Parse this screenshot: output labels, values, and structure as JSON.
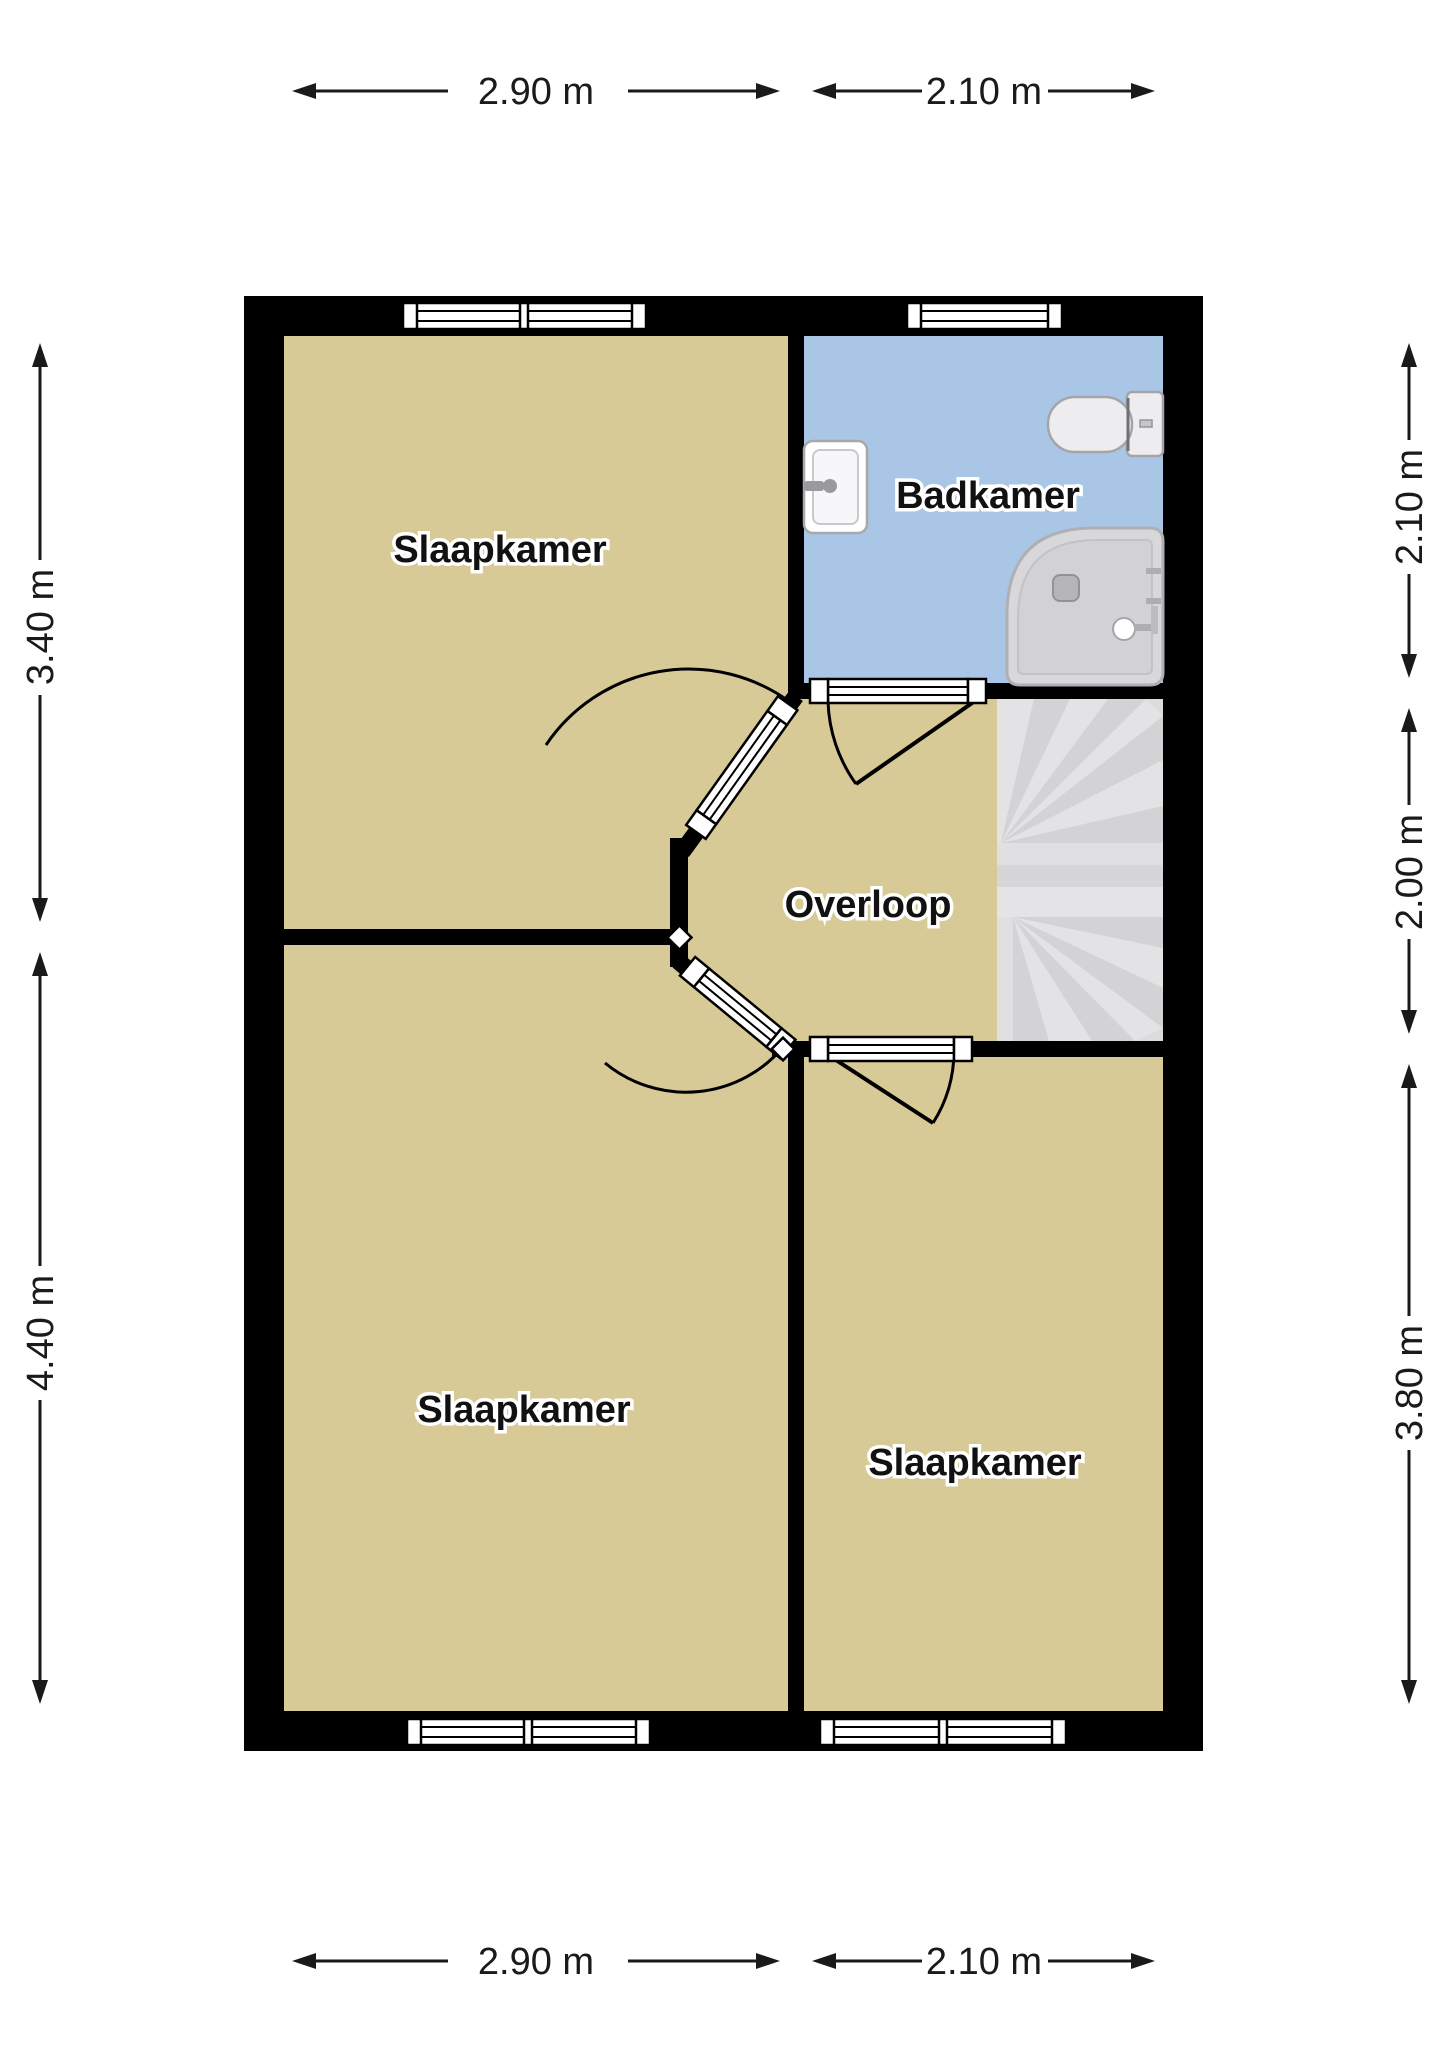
{
  "plan": {
    "title": "Verdieping plattegrond",
    "rooms": [
      {
        "name": "Slaapkamer",
        "type": "bedroom",
        "position": "top-left"
      },
      {
        "name": "Badkamer",
        "type": "bathroom",
        "position": "top-right"
      },
      {
        "name": "Overloop",
        "type": "landing",
        "position": "center"
      },
      {
        "name": "Slaapkamer",
        "type": "bedroom",
        "position": "bottom-left"
      },
      {
        "name": "Slaapkamer",
        "type": "bedroom",
        "position": "bottom-right"
      }
    ],
    "dimensions": {
      "top": [
        "2.90 m",
        "2.10 m"
      ],
      "bottom": [
        "2.90 m",
        "2.10 m"
      ],
      "left": [
        "3.40 m",
        "4.40 m"
      ],
      "right": [
        "2.10 m",
        "2.00 m",
        "3.80 m"
      ]
    },
    "fixtures": [
      "sink-icon",
      "toilet-icon",
      "shower-icon",
      "stairs-icon"
    ],
    "colors": {
      "floor": "#d8ca96",
      "bathroom_floor": "#a9c6e6",
      "wall": "#000000",
      "stairs": "#dcdcdc",
      "background": "#ffffff"
    }
  }
}
